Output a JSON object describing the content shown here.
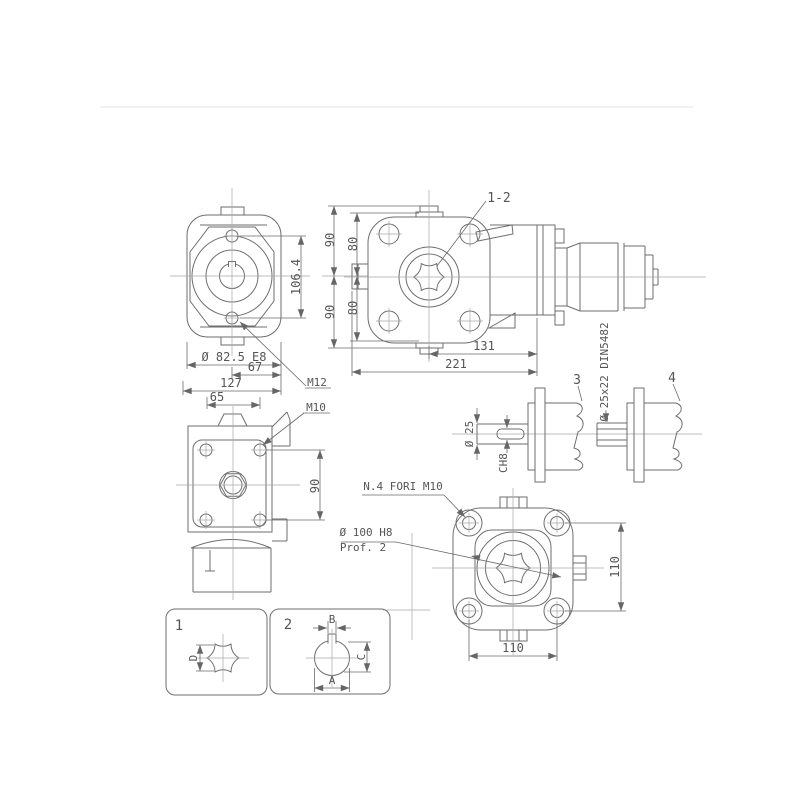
{
  "drawing": {
    "callouts": {
      "input_bore": "1-2",
      "m12": "M12",
      "m10": "M10",
      "option3": "3",
      "option4": "4",
      "spline_spec": "Ø 25x22 DIN5482",
      "holes_note": "N.4 FORI M10",
      "spigot_dia": "Ø 100 H8",
      "spigot_depth": "Prof. 2",
      "detail1": "1",
      "detail2": "2"
    },
    "dims": {
      "front": {
        "bore": "Ø 82.5 E8",
        "w67": "67",
        "w127": "127",
        "w65": "65",
        "h1064": "106.4",
        "t90": "90",
        "t80": "80",
        "b90": "90",
        "b80": "80"
      },
      "plan": {
        "l131": "131",
        "l221": "221"
      },
      "side": {
        "h90": "90"
      },
      "rear": {
        "w110": "110",
        "h110": "110"
      },
      "shaft3": {
        "dia": "Ø 25",
        "key": "CH8"
      },
      "d1": {
        "d": "D"
      },
      "d2": {
        "a": "A",
        "b": "B",
        "c": "C"
      }
    }
  }
}
